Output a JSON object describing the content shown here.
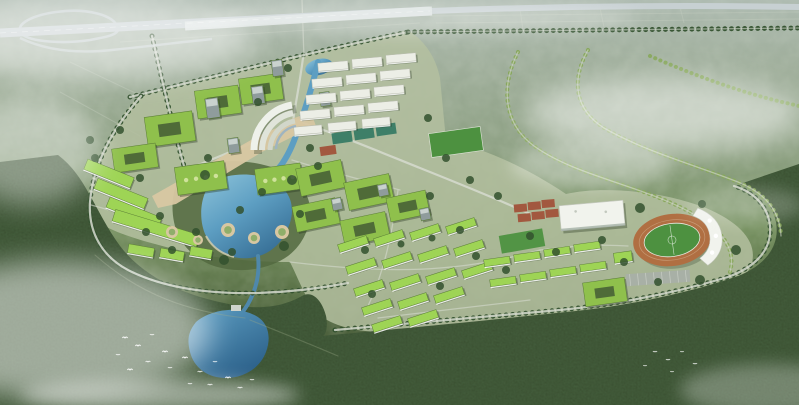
{
  "palette": {
    "haze": "#b6c2b4",
    "fieldLight": "#9fb09c",
    "fieldOlive": "#8aa07e",
    "campusGround": "#b4bfa0",
    "forestDark": "#3c5233",
    "forestDeep": "#2d3e27",
    "forestMid": "#52683f",
    "treeRow": "#33512e",
    "treeLight": "#85a657",
    "roadPale": "#d6dbcf",
    "highway": "#c7d0d2",
    "viaduct": "#dde3e2",
    "water": "#5d9ec2",
    "waterDeep": "#376f96",
    "waterLight": "#8ec4da",
    "roofGreen": "#8fc04c",
    "roofGreenBright": "#9ed455",
    "roofEdge": "#5a7d36",
    "courtyardIn": "#4f6b38",
    "slab": "#eceee6",
    "slabEdge": "#b8bcae",
    "tower": "#8f9c9c",
    "plaza": "#d8c7a2",
    "gardenGreen": "#8fae6a",
    "track": "#b06f42",
    "turf": "#4d9140",
    "courtRed": "#a2583f",
    "courtTeal": "#3e7f68",
    "structureWhite": "#f1f3ed",
    "parking": "#a8b0a6",
    "shadow": "#24341f",
    "mist": "#ffffff",
    "bird": "#ffffff"
  },
  "buildings": [
    {
      "name": "northwest-academic-courtyards",
      "type": "courtyard",
      "rot": -8,
      "items": [
        [
          146,
          114,
          48,
          30
        ],
        [
          196,
          88,
          44,
          28
        ],
        [
          240,
          76,
          42,
          26
        ],
        [
          113,
          146,
          44,
          24
        ]
      ]
    },
    {
      "name": "skylight-halls",
      "type": "hall",
      "rot": -8,
      "items": [
        [
          176,
          164,
          50,
          28
        ],
        [
          256,
          166,
          46,
          26
        ]
      ]
    },
    {
      "name": "west-terraced-building",
      "type": "greenbar",
      "rot": 22,
      "items": [
        [
          84,
          168,
          50,
          11
        ],
        [
          94,
          188,
          54,
          11
        ],
        [
          106,
          207,
          56,
          11
        ]
      ]
    },
    {
      "name": "west-long-bar",
      "type": "greenbar",
      "rot": 17,
      "items": [
        [
          112,
          222,
          88,
          12
        ]
      ]
    },
    {
      "name": "west-small-bars",
      "type": "greenbar",
      "rot": 10,
      "items": [
        [
          128,
          246,
          26,
          9
        ],
        [
          160,
          250,
          24,
          9
        ],
        [
          190,
          248,
          22,
          9
        ]
      ]
    },
    {
      "name": "campus-towers",
      "type": "tower",
      "rot": -8,
      "items": [
        [
          206,
          98,
          13,
          20
        ],
        [
          252,
          86,
          12,
          18
        ],
        [
          272,
          60,
          11,
          16
        ],
        [
          228,
          138,
          11,
          15
        ],
        [
          320,
          92,
          10,
          14
        ]
      ]
    },
    {
      "name": "north-dorm-slabs",
      "type": "slab",
      "rot": -5,
      "items": [
        [
          318,
          62,
          30,
          8
        ],
        [
          352,
          58,
          30,
          8
        ],
        [
          386,
          54,
          30,
          8
        ],
        [
          312,
          78,
          30,
          8
        ],
        [
          346,
          74,
          30,
          8
        ],
        [
          380,
          70,
          30,
          8
        ],
        [
          306,
          94,
          30,
          8
        ],
        [
          340,
          90,
          30,
          8
        ],
        [
          374,
          86,
          30,
          8
        ],
        [
          300,
          110,
          30,
          8
        ],
        [
          334,
          106,
          30,
          8
        ],
        [
          368,
          102,
          30,
          8
        ],
        [
          294,
          126,
          28,
          8
        ],
        [
          328,
          122,
          28,
          8
        ],
        [
          362,
          118,
          28,
          8
        ]
      ]
    },
    {
      "name": "central-academic-courtyards",
      "type": "courtyard",
      "rot": -12,
      "items": [
        [
          298,
          164,
          46,
          28
        ],
        [
          346,
          178,
          46,
          28
        ],
        [
          294,
          202,
          44,
          26
        ],
        [
          342,
          216,
          46,
          26
        ],
        [
          388,
          194,
          40,
          24
        ]
      ]
    },
    {
      "name": "central-annex-towers",
      "type": "tower",
      "rot": -12,
      "items": [
        [
          332,
          198,
          10,
          12
        ],
        [
          378,
          184,
          10,
          12
        ],
        [
          420,
          208,
          10,
          12
        ]
      ]
    },
    {
      "name": "south-dorm-bars",
      "type": "greenbar",
      "rot": -18,
      "items": [
        [
          338,
          240,
          30,
          8
        ],
        [
          374,
          234,
          30,
          8
        ],
        [
          410,
          228,
          30,
          8
        ],
        [
          446,
          222,
          30,
          8
        ],
        [
          346,
          262,
          30,
          8
        ],
        [
          382,
          256,
          30,
          8
        ],
        [
          418,
          250,
          30,
          8
        ],
        [
          454,
          244,
          30,
          8
        ],
        [
          354,
          284,
          30,
          8
        ],
        [
          390,
          278,
          30,
          8
        ],
        [
          426,
          272,
          30,
          8
        ],
        [
          462,
          266,
          30,
          8
        ],
        [
          362,
          303,
          30,
          8
        ],
        [
          398,
          297,
          30,
          8
        ],
        [
          434,
          291,
          30,
          8
        ],
        [
          372,
          320,
          30,
          8
        ],
        [
          408,
          314,
          30,
          8
        ]
      ]
    },
    {
      "name": "east-dorm-bars",
      "type": "greenbar",
      "rot": -8,
      "items": [
        [
          484,
          258,
          26,
          7
        ],
        [
          514,
          253,
          26,
          7
        ],
        [
          544,
          248,
          26,
          7
        ],
        [
          574,
          243,
          26,
          7
        ],
        [
          490,
          278,
          26,
          7
        ],
        [
          520,
          273,
          26,
          7
        ],
        [
          550,
          268,
          26,
          7
        ],
        [
          580,
          263,
          26,
          7
        ],
        [
          614,
          252,
          18,
          10
        ]
      ]
    },
    {
      "name": "east-courtyard-dorm",
      "type": "courtyard",
      "rot": -8,
      "items": [
        [
          584,
          280,
          42,
          24
        ]
      ]
    }
  ],
  "tree_clumps": [
    [
      205,
      175,
      5
    ],
    [
      292,
      180,
      5
    ],
    [
      300,
      214,
      4
    ],
    [
      284,
      246,
      5
    ],
    [
      224,
      260,
      5
    ],
    [
      196,
      232,
      4
    ],
    [
      208,
      158,
      4
    ],
    [
      318,
      166,
      4
    ],
    [
      160,
      216,
      4
    ],
    [
      146,
      232,
      4
    ],
    [
      365,
      250,
      4
    ],
    [
      401,
      244,
      3.5
    ],
    [
      432,
      238,
      3.5
    ],
    [
      372,
      294,
      4
    ],
    [
      440,
      286,
      4
    ],
    [
      476,
      256,
      4
    ],
    [
      506,
      270,
      4
    ],
    [
      640,
      208,
      5
    ],
    [
      702,
      204,
      4
    ],
    [
      736,
      250,
      5
    ],
    [
      700,
      280,
      5
    ],
    [
      658,
      282,
      4
    ],
    [
      288,
      68,
      4
    ],
    [
      258,
      102,
      4
    ],
    [
      428,
      118,
      4
    ],
    [
      446,
      158,
      4
    ],
    [
      470,
      180,
      4
    ],
    [
      498,
      196,
      4
    ],
    [
      95,
      158,
      4
    ],
    [
      140,
      178,
      4
    ],
    [
      172,
      250,
      4
    ],
    [
      232,
      252,
      4
    ],
    [
      120,
      130,
      4
    ],
    [
      90,
      140,
      4
    ],
    [
      310,
      148,
      4
    ],
    [
      262,
      192,
      4
    ],
    [
      240,
      210,
      4
    ],
    [
      430,
      196,
      4
    ],
    [
      460,
      230,
      4
    ],
    [
      530,
      236,
      4
    ],
    [
      556,
      252,
      4
    ],
    [
      602,
      240,
      4
    ],
    [
      624,
      262,
      4
    ]
  ],
  "garden_circles": [
    [
      228,
      230,
      7
    ],
    [
      254,
      238,
      6
    ],
    [
      282,
      232,
      7
    ],
    [
      172,
      232,
      6
    ],
    [
      198,
      240,
      5
    ]
  ],
  "birds": [
    [
      125,
      338,
      1
    ],
    [
      138,
      346,
      1
    ],
    [
      152,
      335,
      0.8
    ],
    [
      165,
      352,
      1
    ],
    [
      148,
      362,
      0.9
    ],
    [
      130,
      370,
      1
    ],
    [
      170,
      368,
      0.8
    ],
    [
      185,
      358,
      1
    ],
    [
      200,
      372,
      0.9
    ],
    [
      215,
      362,
      0.8
    ],
    [
      228,
      378,
      1
    ],
    [
      210,
      385,
      0.9
    ],
    [
      190,
      384,
      0.8
    ],
    [
      240,
      388,
      0.9
    ],
    [
      252,
      380,
      0.8
    ],
    [
      118,
      355,
      0.8
    ],
    [
      655,
      352,
      0.8
    ],
    [
      668,
      360,
      0.8
    ],
    [
      682,
      352,
      0.7
    ],
    [
      695,
      364,
      0.8
    ],
    [
      672,
      372,
      0.7
    ],
    [
      645,
      366,
      0.7
    ]
  ]
}
